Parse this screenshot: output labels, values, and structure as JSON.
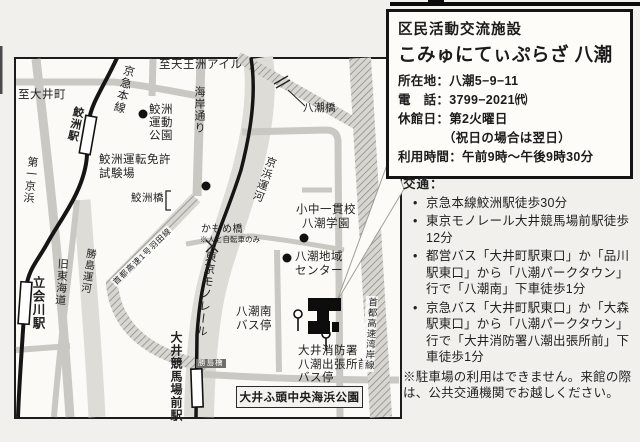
{
  "info_box": {
    "category": "区民活動交流施設",
    "facility_name": "こみゅにてぃぷらざ 八潮",
    "rows": [
      "所在地：八潮5−9−11",
      "電　話：3799−2021㈹",
      "休館日：第2火曜日",
      "　　　　（祝日の場合は翌日）",
      "利用時間：午前9時〜午後9時30分"
    ]
  },
  "access": {
    "heading": "交通：",
    "items": [
      "京急本線鮫洲駅徒歩30分",
      "東京モノレール大井競馬場前駅徒歩12分",
      "都営バス「大井町駅東口」か「品川駅東口」から「八潮パークタウン」行で「八潮南」下車徒歩1分",
      "京急バス「大井町駅東口」か「大森駅東口」から「八潮パークタウン」行で「大井消防署八潮出張所前」下車徒歩1分"
    ],
    "note": "※駐車場の利用はできません。来館の際は、公共交通機関でお越しください。"
  },
  "map": {
    "labels": {
      "to_oimachi": "至大井町",
      "to_tennozu": "至天王洲アイル",
      "keikyu_line": "京急本線",
      "samezu_station": "鮫洲駅",
      "daiichi_keihin": "第一京浜",
      "samezu_sports_park": "鮫洲\n運動\n公園",
      "kaigan_dori": "海岸通り",
      "samezu_license_center": "鮫洲運転免許\n試験場",
      "samezu_bridge": "鮫洲橋",
      "haneda_expressway": "首都高速1号羽田線",
      "kyu_tokaido": "旧東海道",
      "katsushima_canal": "勝島運河",
      "tachiaigawa_station": "立会川駅",
      "keihin_canal": "京浜運河",
      "tokyo_monorail": "東京モノレール",
      "kamome_bridge": "かもめ橋",
      "kamome_bridge_note": "※人と自転車のみ",
      "yashio_bridge": "八潮橋",
      "school": "小中一貫校\n八潮学園",
      "community_center": "八潮地域\nセンター",
      "oi_keibajo_station": "大井競馬場前駅",
      "katsushima_bridge": "勝島橋",
      "yashio_minami_bus_stop": "八潮南\nバス停",
      "fire_station_bus_stop": "大井消防署\n八潮出張所前\nバス停",
      "oi_wharf_park": "大井ふ頭中央海浜公園",
      "wangan_expressway": "首都高速湾岸線"
    }
  },
  "colors": {
    "road": "#cac8c3",
    "canal": "#dedcd6",
    "railway": "#151515",
    "frame": "#1c1c1c",
    "paper": "#f1f0ec"
  }
}
